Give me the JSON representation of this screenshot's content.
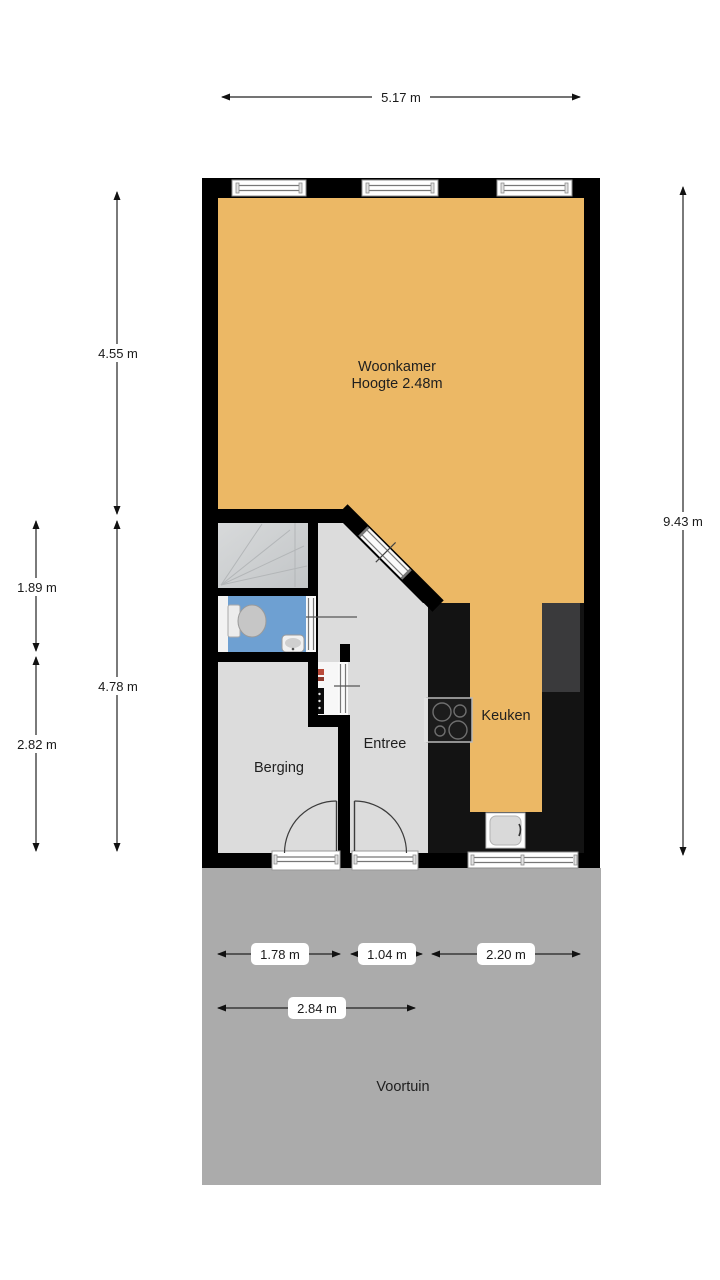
{
  "title": "Floor plan ground floor",
  "rooms": {
    "woonkamer": {
      "label": "Woonkamer",
      "height_note": "Hoogte 2.48m"
    },
    "keuken": {
      "label": "Keuken"
    },
    "entree": {
      "label": "Entree"
    },
    "berging": {
      "label": "Berging"
    },
    "voortuin": {
      "label": "Voortuin"
    }
  },
  "dimensions": {
    "top_width": "5.17 m",
    "left_woonkamer_depth": "4.55 m",
    "left_hall_total_depth": "4.78 m",
    "outer_stairs_toilet_depth": "1.89 m",
    "outer_berging_depth": "2.82 m",
    "right_total_depth": "9.43 m",
    "bottom_berging_width": "1.78 m",
    "bottom_entree_width": "1.04 m",
    "bottom_keuken_width": "2.20 m",
    "bottom_total_width": "2.84 m"
  },
  "colors": {
    "living_floor": "#ecb865",
    "hall_floor": "#dcdcdc",
    "berging_floor": "#dcdcdc",
    "stairs_light": "#d6d8d9",
    "stairs_dark": "#c3c6c8",
    "toilet_blue": "#6ea0d2",
    "garden_gray": "#ababab",
    "wall_black": "#000000",
    "counter_dark": "#131313",
    "tall_unit_gray": "#3a3a3c"
  }
}
